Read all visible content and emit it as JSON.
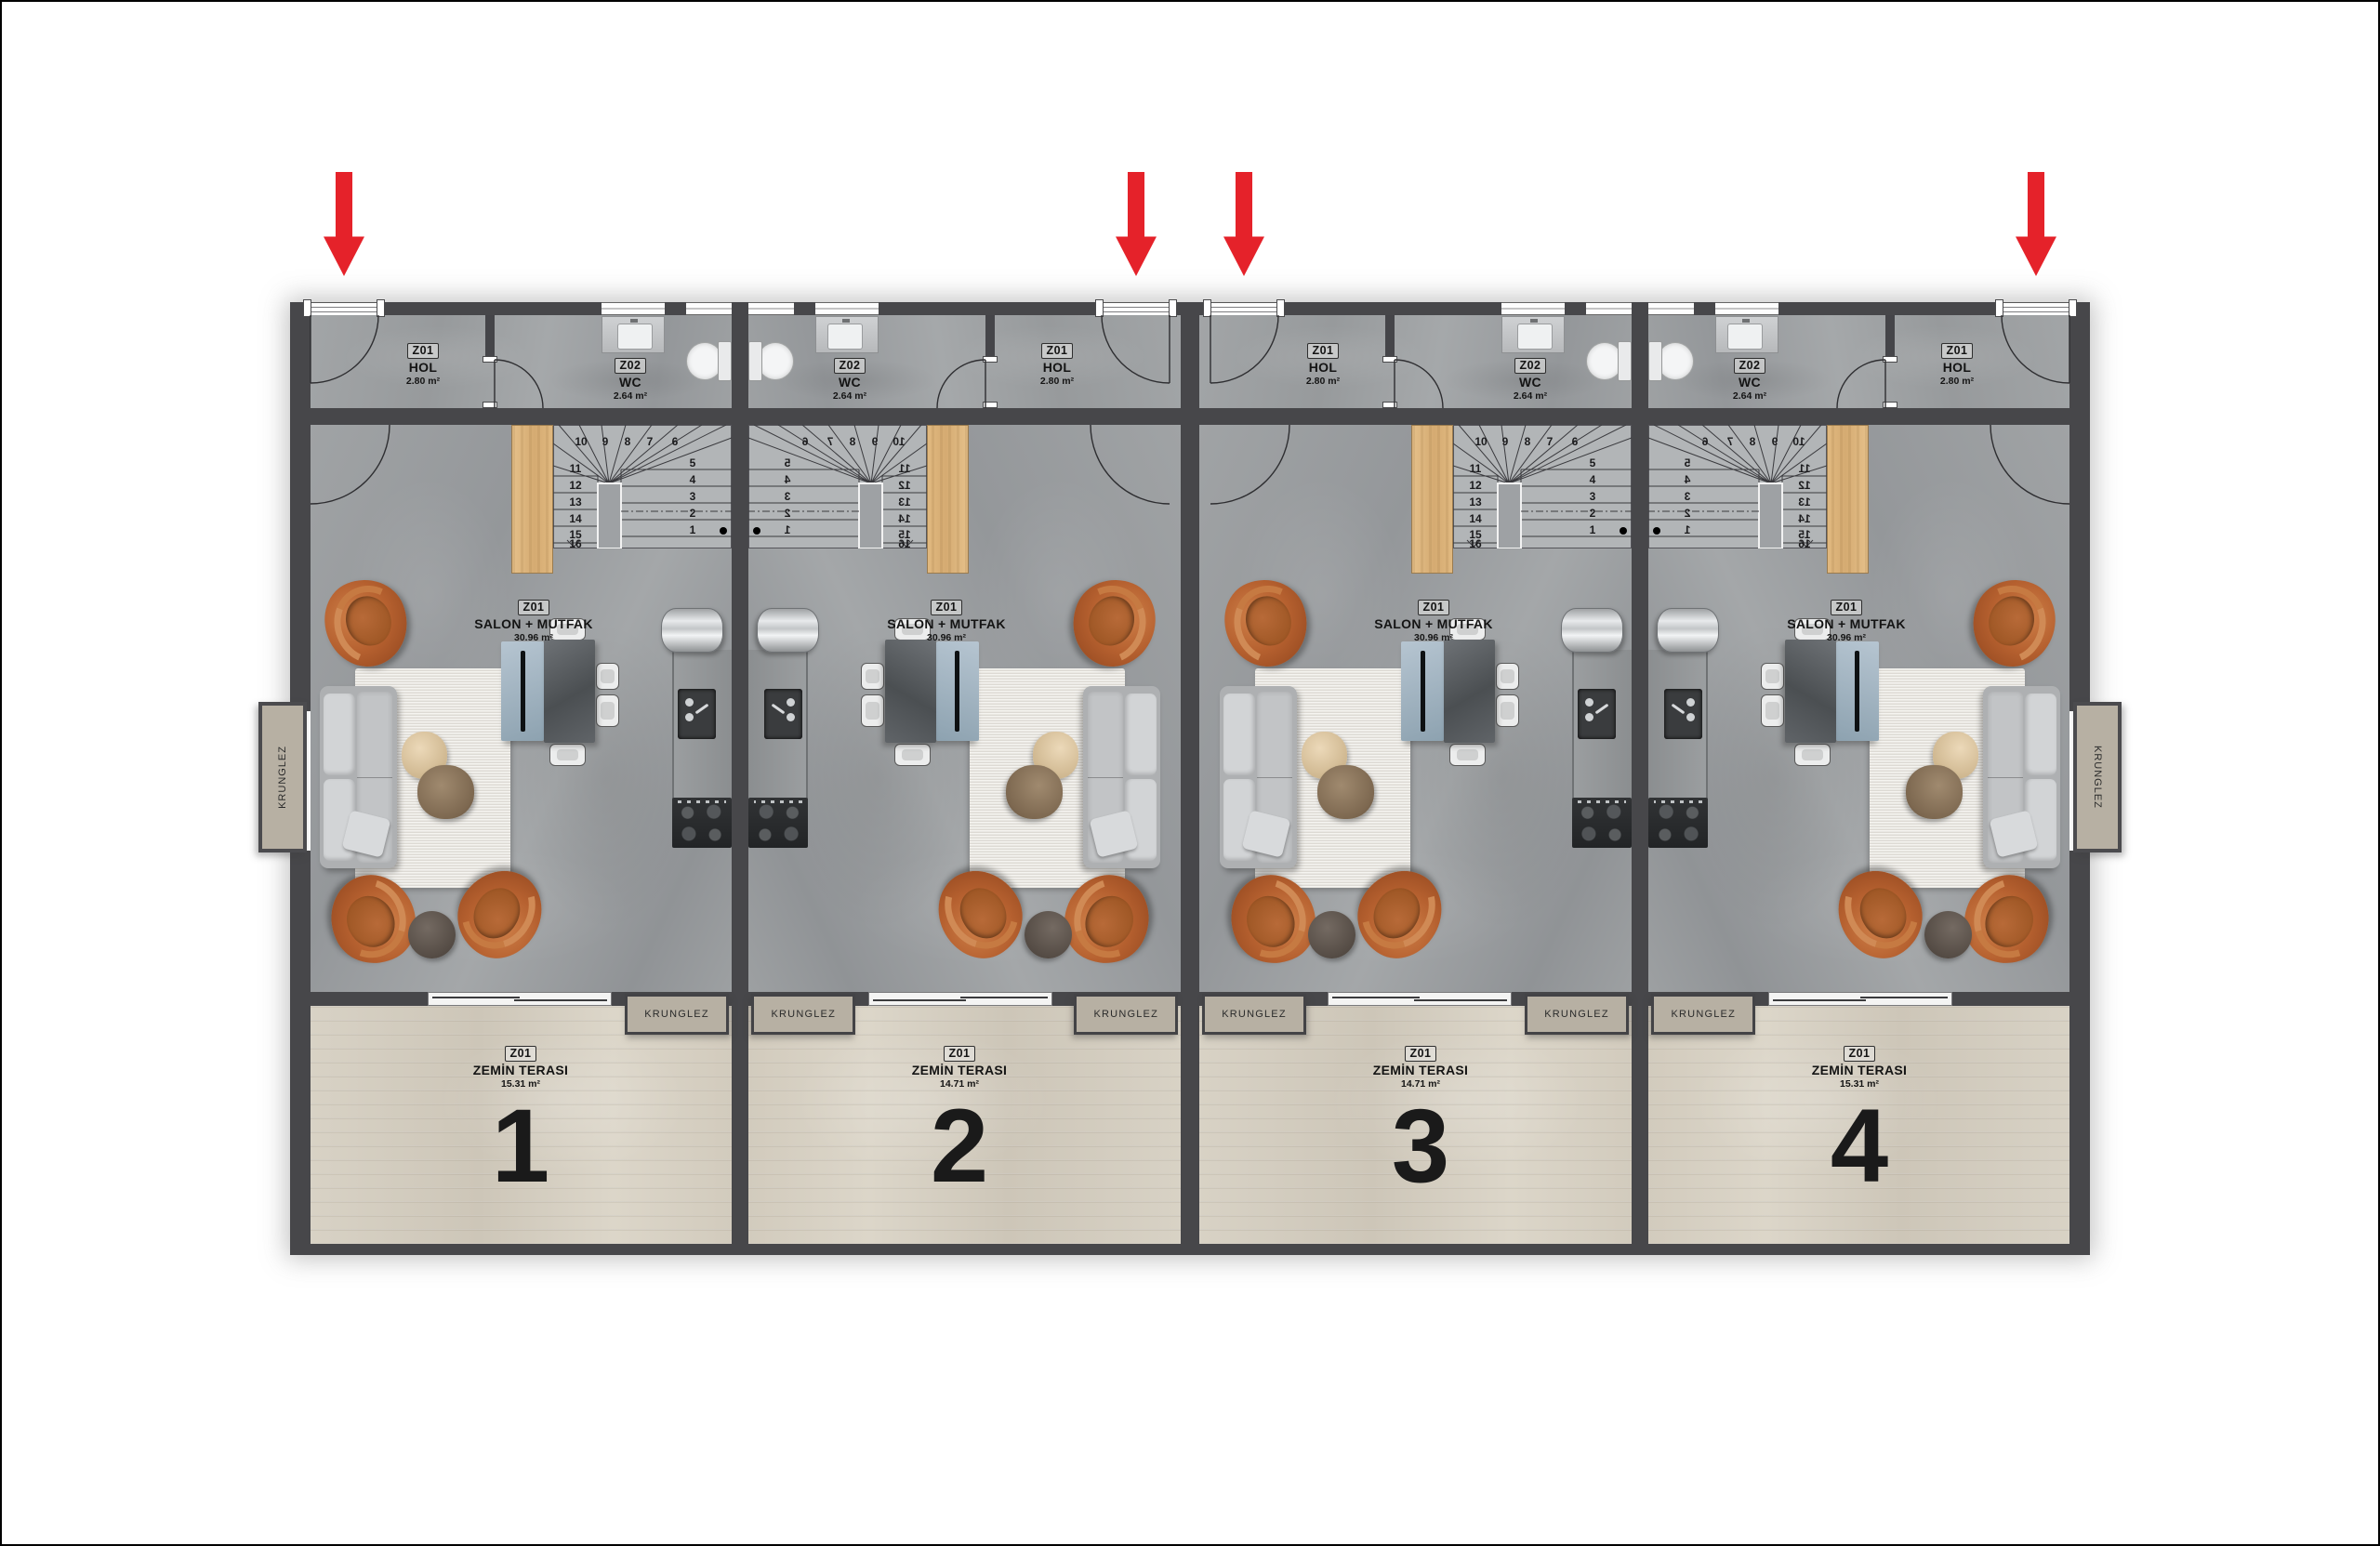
{
  "labels": {
    "krunglez": "KRUNGLEZ"
  },
  "colors": {
    "wall": "#47474a",
    "floor_gray": "#9da0a2",
    "terrace_wood": "#d6cfc2",
    "stair_floor": "#b2b5b7",
    "wood_panel": "#ddb584",
    "arrow_red": "#e5222a",
    "krunglez_box": "#b7b0a3",
    "armchair_orange": "#b5602f",
    "rug_cream": "#e9e6df"
  },
  "stairs": {
    "top_numbers": [
      "10",
      "9",
      "8",
      "7",
      "6"
    ],
    "left_numbers": [
      "11",
      "12",
      "13",
      "14",
      "15",
      "16"
    ],
    "right_numbers": [
      "5",
      "4",
      "3",
      "2",
      "1"
    ]
  },
  "units": [
    {
      "number": "1",
      "orientation": "normal",
      "type": "outer",
      "hol": {
        "tag": "Z01",
        "name": "HOL",
        "area": "2.80 m²"
      },
      "wc": {
        "tag": "Z02",
        "name": "WC",
        "area": "2.64 m²"
      },
      "salon": {
        "tag": "Z01",
        "name": "SALON + MUTFAK",
        "area": "30.96 m²"
      },
      "terrace": {
        "tag": "Z01",
        "name": "ZEMİN TERASI",
        "area": "15.31 m²"
      }
    },
    {
      "number": "2",
      "orientation": "flipped",
      "type": "inner",
      "hol": {
        "tag": "Z01",
        "name": "HOL",
        "area": "2.80 m²"
      },
      "wc": {
        "tag": "Z02",
        "name": "WC",
        "area": "2.64 m²"
      },
      "salon": {
        "tag": "Z01",
        "name": "SALON + MUTFAK",
        "area": "30.96 m²"
      },
      "terrace": {
        "tag": "Z01",
        "name": "ZEMİN TERASI",
        "area": "14.71 m²"
      }
    },
    {
      "number": "3",
      "orientation": "normal",
      "type": "inner",
      "hol": {
        "tag": "Z01",
        "name": "HOL",
        "area": "2.80 m²"
      },
      "wc": {
        "tag": "Z02",
        "name": "WC",
        "area": "2.64 m²"
      },
      "salon": {
        "tag": "Z01",
        "name": "SALON + MUTFAK",
        "area": "30.96 m²"
      },
      "terrace": {
        "tag": "Z01",
        "name": "ZEMİN TERASI",
        "area": "14.71 m²"
      }
    },
    {
      "number": "4",
      "orientation": "flipped",
      "type": "outer",
      "hol": {
        "tag": "Z01",
        "name": "HOL",
        "area": "2.80 m²"
      },
      "wc": {
        "tag": "Z02",
        "name": "WC",
        "area": "2.64 m²"
      },
      "salon": {
        "tag": "Z01",
        "name": "SALON + MUTFAK",
        "area": "30.96 m²"
      },
      "terrace": {
        "tag": "Z01",
        "name": "ZEMİN TERASI",
        "area": "15.31 m²"
      }
    }
  ]
}
